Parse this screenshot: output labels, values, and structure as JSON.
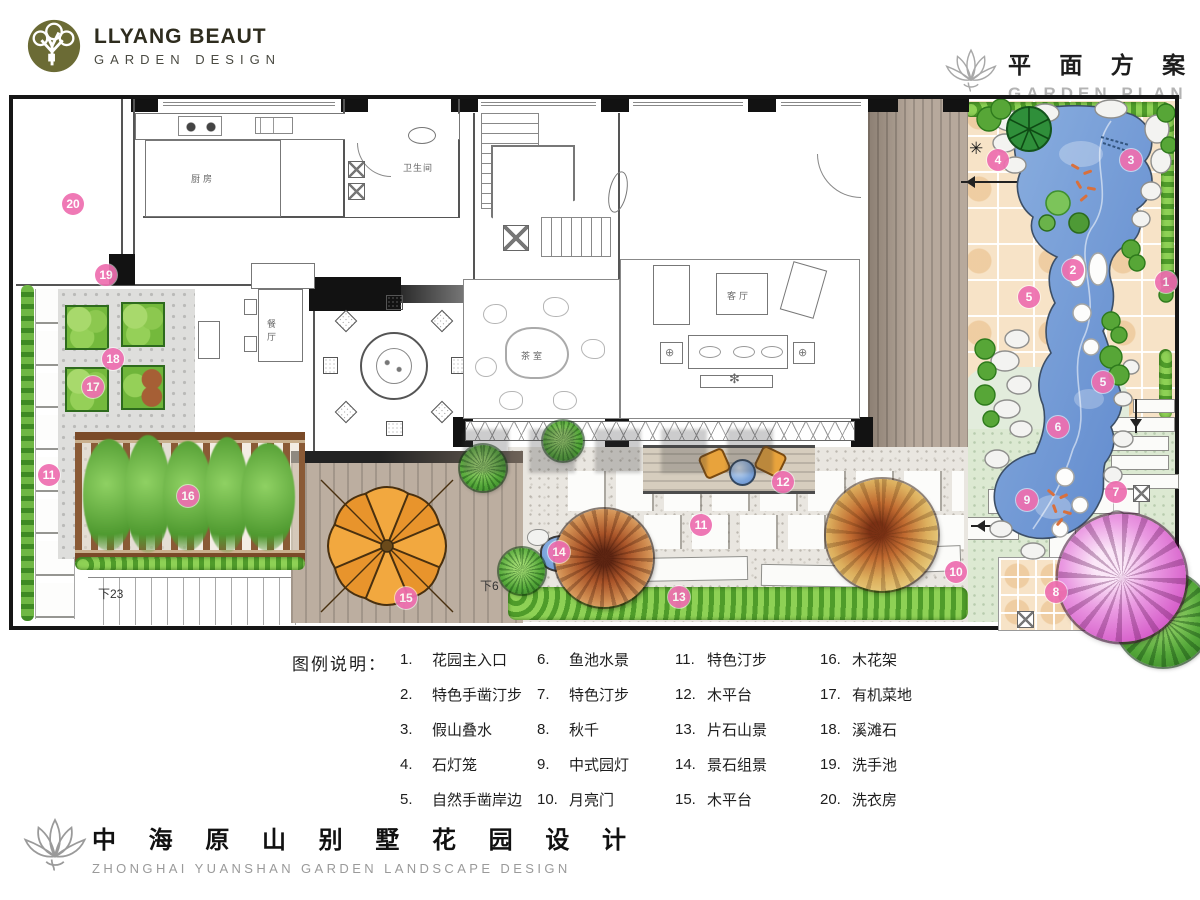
{
  "header": {
    "logo_line1": "LLYANG BEAUT",
    "logo_line2": "GARDEN DESIGN",
    "plan_title_cn": "平 面 方 案",
    "plan_title_en": "GARDEN PLAN"
  },
  "plan": {
    "labels": {
      "kitchen": "厨房",
      "bathroom": "卫生间",
      "dining": "餐厅",
      "tea_room": "茶室",
      "living_room": "客厅",
      "stairs_left": "下23",
      "stairs_mid": "下6"
    },
    "markers": [
      {
        "n": "20",
        "x": 60,
        "y": 105
      },
      {
        "n": "19",
        "x": 93,
        "y": 176
      },
      {
        "n": "18",
        "x": 100,
        "y": 260
      },
      {
        "n": "17",
        "x": 80,
        "y": 288
      },
      {
        "n": "11",
        "x": 36,
        "y": 376
      },
      {
        "n": "16",
        "x": 175,
        "y": 397
      },
      {
        "n": "15",
        "x": 393,
        "y": 499
      },
      {
        "n": "14",
        "x": 546,
        "y": 453
      },
      {
        "n": "13",
        "x": 666,
        "y": 498
      },
      {
        "n": "11",
        "x": 688,
        "y": 426
      },
      {
        "n": "12",
        "x": 770,
        "y": 383
      },
      {
        "n": "6",
        "x": 1045,
        "y": 328
      },
      {
        "n": "9",
        "x": 1014,
        "y": 401
      },
      {
        "n": "7",
        "x": 1103,
        "y": 393
      },
      {
        "n": "10",
        "x": 943,
        "y": 473
      },
      {
        "n": "8",
        "x": 1043,
        "y": 493
      },
      {
        "n": "4",
        "x": 985,
        "y": 61
      },
      {
        "n": "3",
        "x": 1118,
        "y": 61
      },
      {
        "n": "2",
        "x": 1060,
        "y": 171
      },
      {
        "n": "1",
        "x": 1153,
        "y": 183
      },
      {
        "n": "5",
        "x": 1016,
        "y": 198
      },
      {
        "n": "5",
        "x": 1090,
        "y": 283
      }
    ],
    "marker_color": "#ee6fb0",
    "water_color": "#6f9bd8"
  },
  "legend": {
    "title": "图例说明：",
    "columns": [
      [
        {
          "num": "1.",
          "label": "花园主入口"
        },
        {
          "num": "2.",
          "label": "特色手凿汀步"
        },
        {
          "num": "3.",
          "label": "假山叠水"
        },
        {
          "num": "4.",
          "label": "石灯笼"
        },
        {
          "num": "5.",
          "label": "自然手凿岸边"
        }
      ],
      [
        {
          "num": "6.",
          "label": "鱼池水景"
        },
        {
          "num": "7.",
          "label": "特色汀步"
        },
        {
          "num": "8.",
          "label": "秋千"
        },
        {
          "num": "9.",
          "label": "中式园灯"
        },
        {
          "num": "10.",
          "label": "月亮门"
        }
      ],
      [
        {
          "num": "11.",
          "label": "特色汀步"
        },
        {
          "num": "12.",
          "label": "木平台"
        },
        {
          "num": "13.",
          "label": "片石山景"
        },
        {
          "num": "14.",
          "label": "景石组景"
        },
        {
          "num": "15.",
          "label": "木平台"
        }
      ],
      [
        {
          "num": "16.",
          "label": "木花架"
        },
        {
          "num": "17.",
          "label": "有机菜地"
        },
        {
          "num": "18.",
          "label": "溪滩石"
        },
        {
          "num": "19.",
          "label": "洗手池"
        },
        {
          "num": "20.",
          "label": "洗衣房"
        }
      ]
    ]
  },
  "footer": {
    "title_cn": "中 海 原 山 别 墅 花 园 设 计",
    "title_en": "ZHONGHAI YUANSHAN GARDEN LANDSCAPE DESIGN"
  }
}
